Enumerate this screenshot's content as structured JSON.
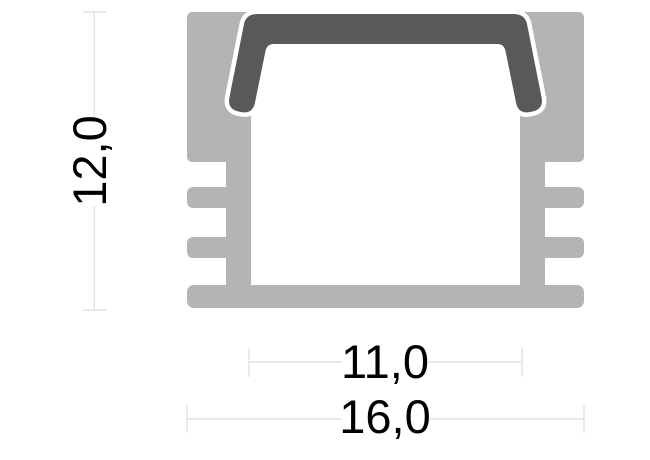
{
  "diagram": {
    "name": "aluminium-led-profile-cross-section",
    "description": "Technical cross-section drawing of a surface-mounted aluminium LED profile with snap-in diffuser cover and two dimension lines",
    "dimensions": {
      "height": {
        "label": "12,0",
        "value_mm": 12.0
      },
      "inner_width": {
        "label": "11,0",
        "value_mm": 11.0
      },
      "outer_width": {
        "label": "16,0",
        "value_mm": 16.0
      }
    },
    "colors": {
      "aluminum": "#b4b4b4",
      "cover": "#595959",
      "gap": "#ffffff",
      "dimension_line": "#e2e2e2",
      "label_text": "#000000",
      "background": "#ffffff"
    }
  }
}
